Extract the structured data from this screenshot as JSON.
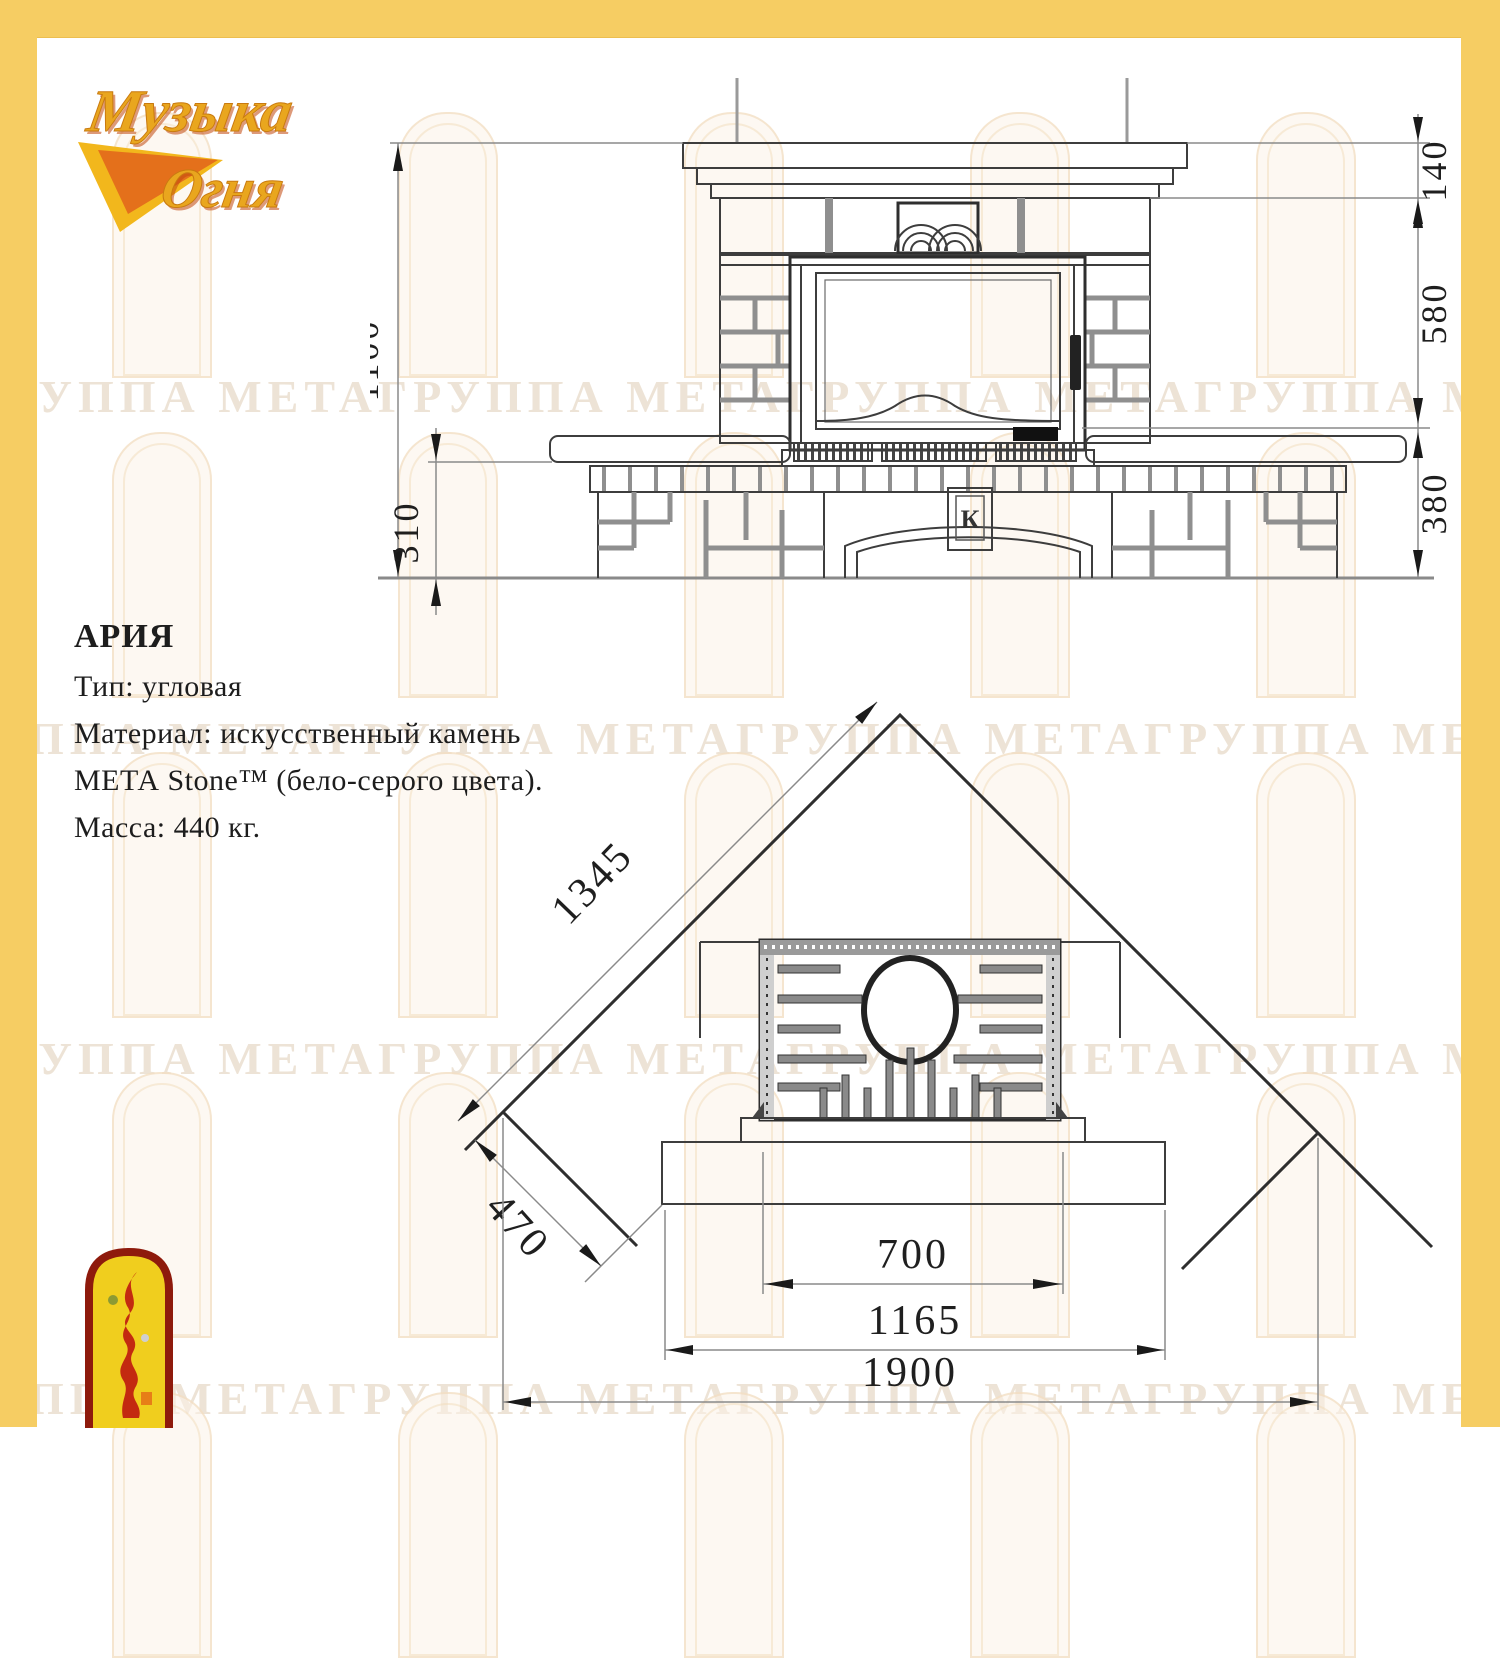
{
  "colors": {
    "frame_yellow": "#F6CD63",
    "drawing_line": "#3d3d3d",
    "dimension_gray": "#8a8a8a",
    "watermark_text": "rgba(199,167,127,0.32)",
    "emblem_red": "#8E1A0C",
    "emblem_yellow": "#F0CE1E",
    "logo_gold": "#E9A61E"
  },
  "logo": {
    "line1": "Музыка",
    "line2": "Огня"
  },
  "watermark": {
    "text": "ГРУППА МЕТАГРУППА МЕТАГРУППА МЕТАГРУППА МЕТА"
  },
  "product": {
    "name": "АРИЯ",
    "type_line": "Тип: угловая",
    "material_line1": "Материал: искусственный камень",
    "material_line2": "МЕТА Stone™ (бело-серого цвета).",
    "mass_line": "Масса: 440 кг."
  },
  "front_view": {
    "dims": {
      "total_height": "1100",
      "bench_height": "310",
      "shelf_height": "140",
      "middle_height": "580",
      "base_height": "380"
    },
    "emblem_letter": "К"
  },
  "plan_view": {
    "dims": {
      "wall_length": "1345",
      "corner_depth": "470",
      "firebox_width": "700",
      "base_width": "1165",
      "overall_width": "1900"
    }
  }
}
